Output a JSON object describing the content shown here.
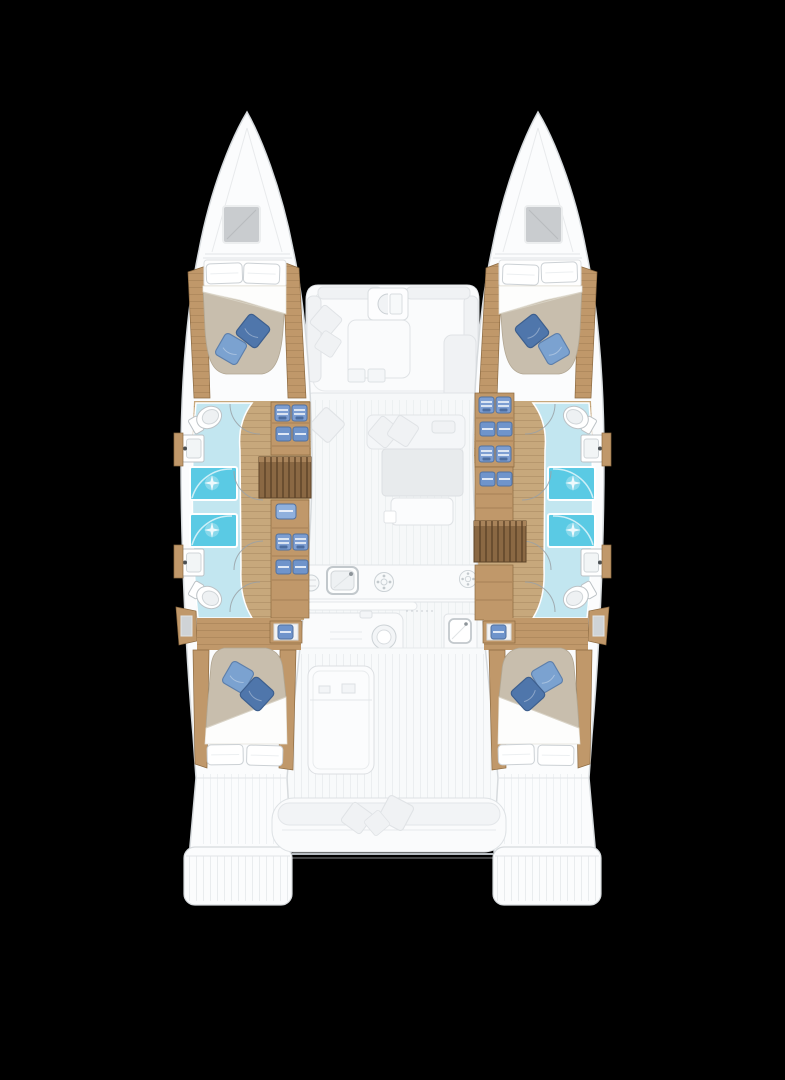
{
  "canvas": {
    "width": 785,
    "height": 1080
  },
  "image": {
    "type": "boat-floor-plan",
    "subject": "catamaran sailing yacht deck / accommodation plan, top-down view, bows up",
    "layout_summary": "Two hulls each with a forward double cabin, two bathrooms with showers and toilets amidships, wardrobe shelving, companionway stairs and an aft double cabin; faded central nacelle with forward cockpit, saloon sofa, galley with sinks and burners, aft cockpit with table and full-beam bench; twin stern swim platforms",
    "text_content": "none"
  },
  "colors": {
    "bg": "#000000",
    "hull": "#fbfcfd",
    "hullStroke": "#d6dadd",
    "deckStroke": "#e2e5e8",
    "furn": "#fafbfc",
    "furnMid": "#f0f2f4",
    "furnDark": "#e8ebed",
    "furnEdge": "#dcdfe2",
    "furnStroke": "#e0e3e6",
    "wood": "#c0986a",
    "woodDark": "#8c6a41",
    "corridor": "#c7a87c",
    "stairs": "#8a6843",
    "stairsDark": "#5d4428",
    "stairsLight": "#a8835a",
    "bath": "#c2e6f0",
    "shower": "#5acae4",
    "duvet": "#c8bead",
    "duvetEdge": "#b1a692",
    "sheet": "#fdfdfc",
    "pillowDark": "#4f76ab",
    "pillowDarkEdge": "#3d5f8e",
    "pillowLight": "#7ba2d0",
    "pillowLightEdge": "#5d7fab",
    "linenStroke": "#ccd1d5",
    "fixtureStroke": "#bcc2c6",
    "clothes": "#7d9ed2",
    "clothesDark": "#51719f"
  },
  "components": {
    "port_hull": [
      "bow-hatch",
      "forward-double-berth",
      "blue-cushions",
      "forward-bathroom",
      "aft-bathroom",
      "showers",
      "toilets",
      "washbasins",
      "wardrobe-shelves",
      "companionway-stairs",
      "aft-double-berth",
      "stern-platform"
    ],
    "starboard_hull": [
      "bow-hatch",
      "forward-double-berth",
      "blue-cushions",
      "forward-bathroom",
      "aft-bathroom",
      "showers",
      "toilets",
      "washbasins",
      "wardrobe-shelves",
      "companionway-stairs",
      "aft-double-berth",
      "stern-platform"
    ],
    "center": [
      "forward-cockpit-seating",
      "coffee-table",
      "saloon-sofa",
      "galley-sink",
      "stove-burners",
      "island-counter",
      "aft-galley-module",
      "cockpit-table",
      "aft-bench-with-cushions",
      "stern-crossbeam"
    ]
  }
}
